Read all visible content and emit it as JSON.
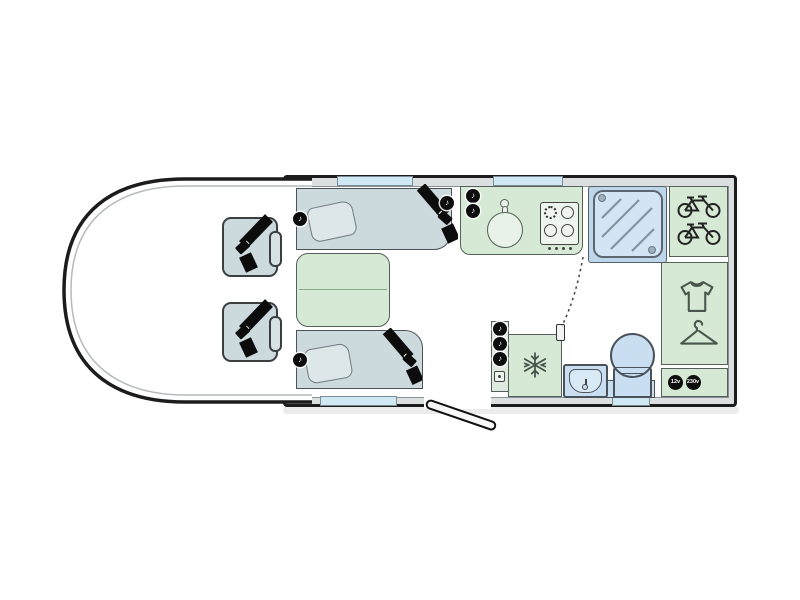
{
  "floorplan": {
    "badges": {
      "dc_socket": "12v",
      "ac_socket": "230v"
    },
    "glyphs": {
      "speaker": "♪"
    },
    "colors": {
      "outline": "#1c1c1c",
      "wall_gray": "#dcdfe0",
      "upholstery": "#ccd9dd",
      "furniture_green": "#d6e9d4",
      "wet_area_blue": "#c9def1",
      "window_blue": "#cfe8f4",
      "seatbelt_black": "#0d0d0d"
    },
    "icons": [
      "seatbelt-icon",
      "speaker-icon",
      "pillow-icon",
      "sink-icon",
      "hob-icon",
      "shower-icon",
      "bicycle-icon",
      "tshirt-icon",
      "hanger-icon",
      "snowflake-icon",
      "toilet-icon",
      "basin-icon",
      "socket-icon",
      "door-swing-icon",
      "entrance-door"
    ]
  }
}
